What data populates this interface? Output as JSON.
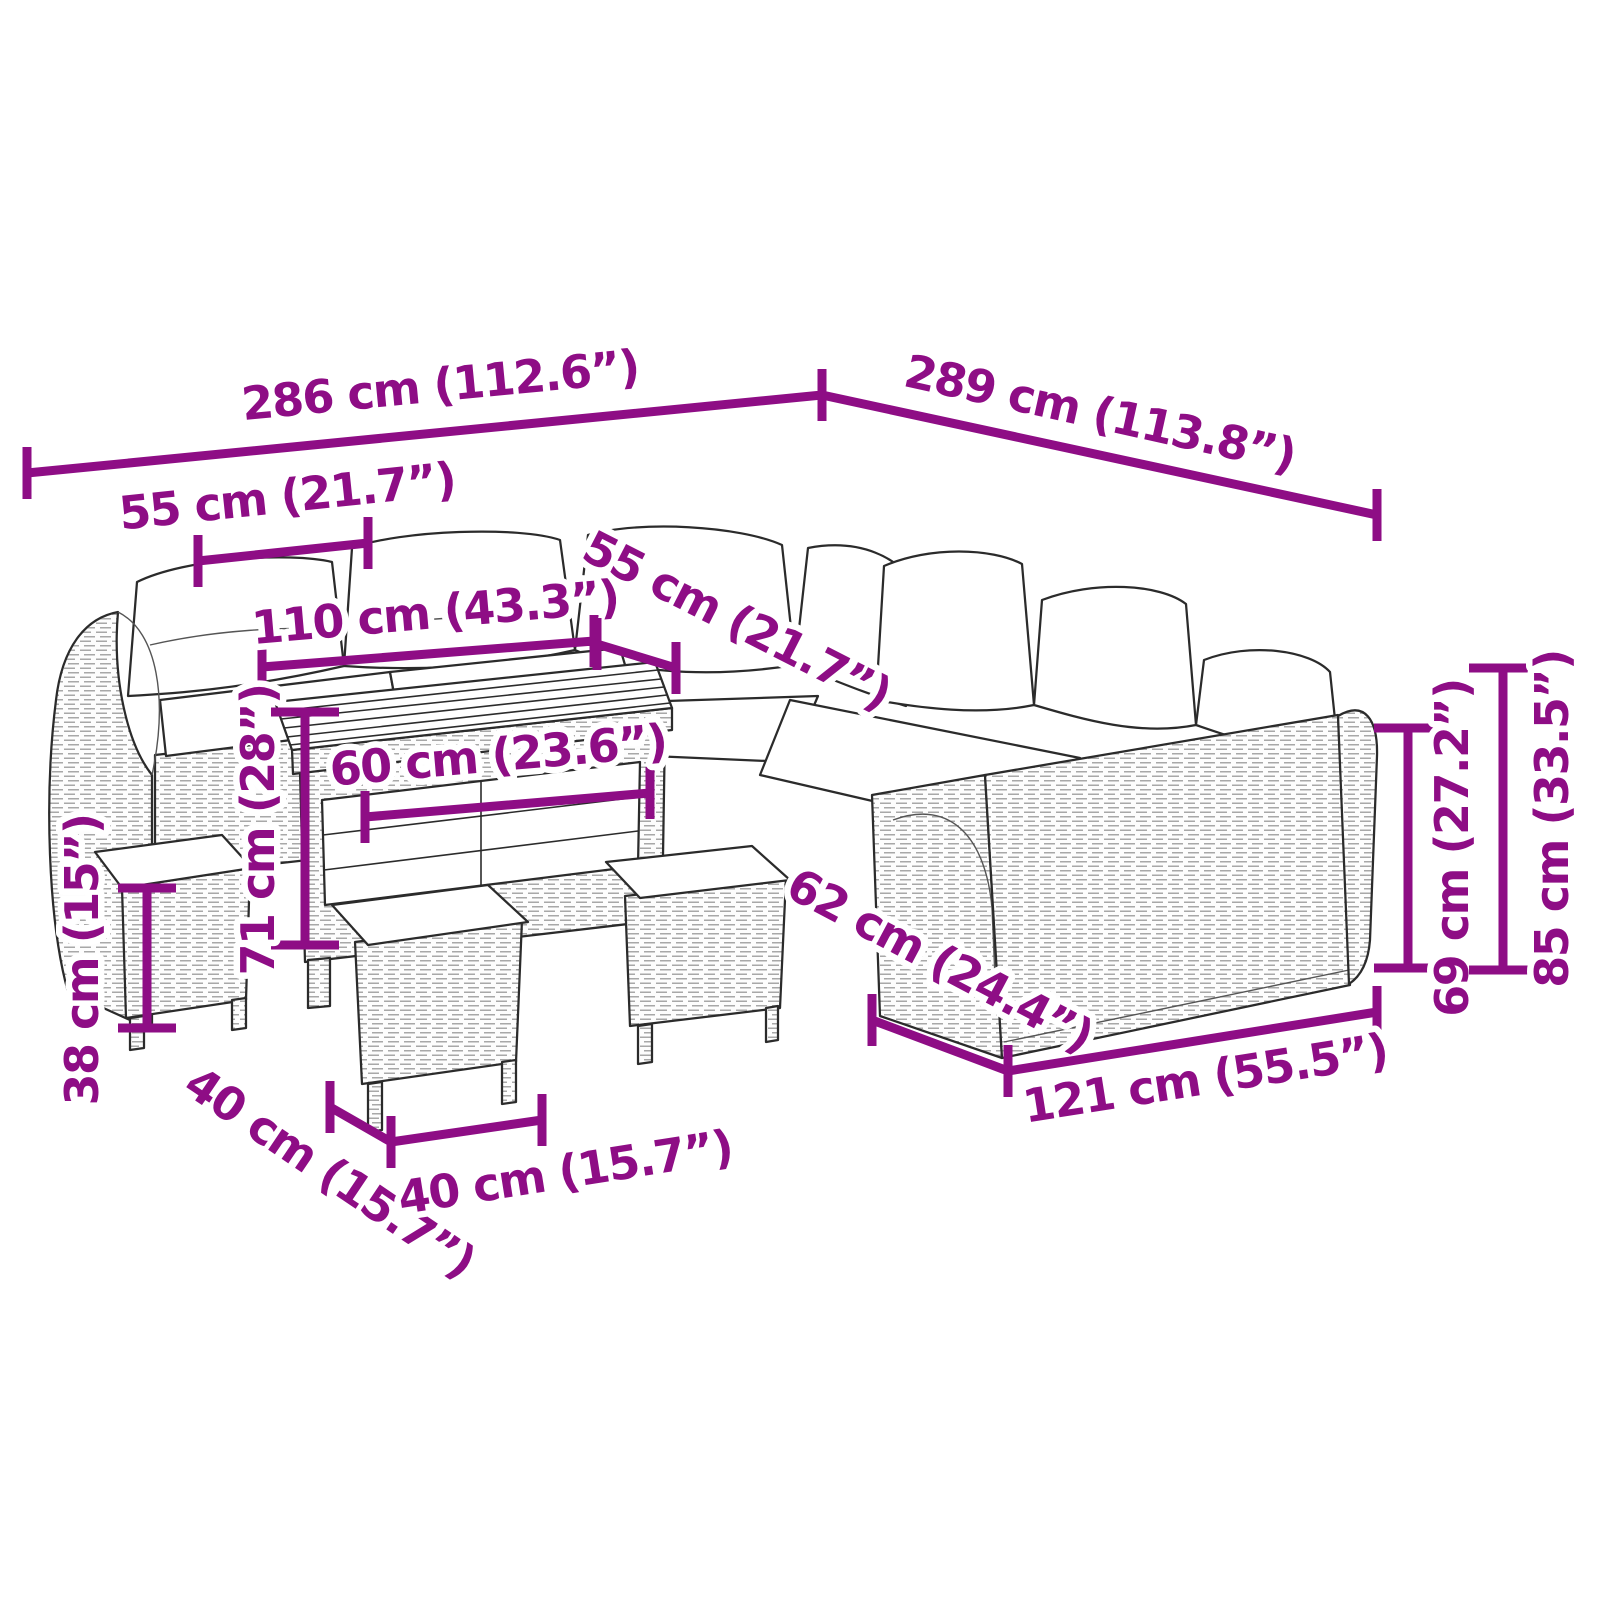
{
  "diagram": {
    "type": "product-dimensions",
    "subject": "garden-lounge-set-with-table-and-stools",
    "accent_color": "#8E0D85",
    "outline_color": "#2b2b2b",
    "background_color": "#ffffff",
    "units": [
      "cm",
      "inches"
    ],
    "dimensions": [
      {
        "name": "overall-width-left",
        "label": "286 cm (112.6”)"
      },
      {
        "name": "overall-width-right",
        "label": "289 cm (113.8”)"
      },
      {
        "name": "seat-width-left",
        "label": "55 cm (21.7”)"
      },
      {
        "name": "inner-sofa-width",
        "label": "110 cm (43.3”)"
      },
      {
        "name": "seat-depth-left",
        "label": "55 cm (21.7”)"
      },
      {
        "name": "table-width",
        "label": "60 cm (23.6”)"
      },
      {
        "name": "table-height",
        "label": "71 cm (28”)"
      },
      {
        "name": "stool-height",
        "label": "38 cm (15”)"
      },
      {
        "name": "stool-depth",
        "label": "40 cm (15.7”)"
      },
      {
        "name": "stool-width",
        "label": "40 cm (15.7”)"
      },
      {
        "name": "right-seat-depth",
        "label": "62 cm (24.4”)"
      },
      {
        "name": "right-section-width",
        "label": "121 cm (55.5”)"
      },
      {
        "name": "backrest-height",
        "label": "69 cm (27.2”)"
      },
      {
        "name": "overall-height",
        "label": "85 cm (33.5”)"
      }
    ]
  }
}
